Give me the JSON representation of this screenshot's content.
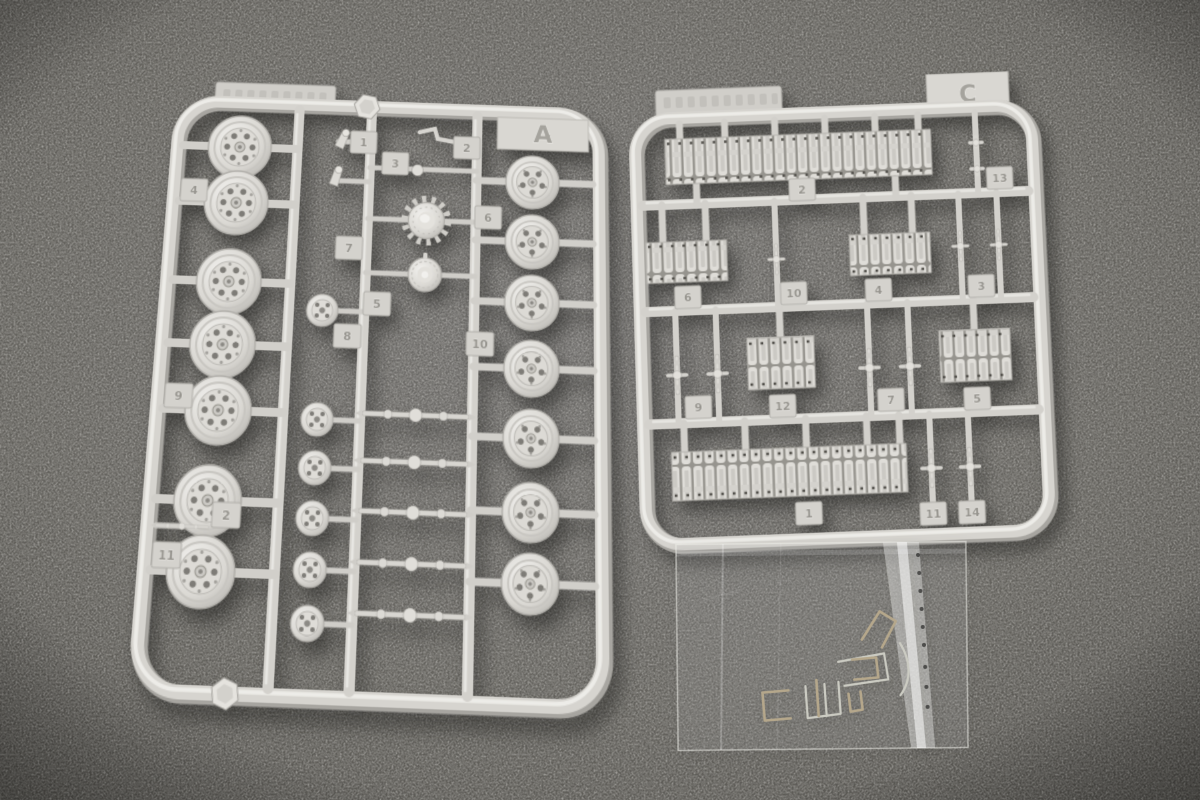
{
  "scene": {
    "description": "Product photograph: two light-gray injection-molded model-kit sprues (runners A and C) holding tank road wheels, a drive sprocket and track-link sections, plus a clear zip bag of bent metal wire parts, lying on dark gray felt",
    "background_color": "#676561",
    "plastic_color": "#d9d7d2",
    "shadow_color": "#2a2926"
  },
  "sprue_a": {
    "letter": "A",
    "part_tabs": [
      "1",
      "3",
      "2",
      "4",
      "7",
      "5",
      "8",
      "9",
      "2",
      "11",
      "6",
      "10"
    ],
    "embossed_maker_text_legible": false
  },
  "sprue_c": {
    "letter": "C",
    "part_tabs": [
      "2",
      "13",
      "6",
      "10",
      "4",
      "3",
      "9",
      "12",
      "7",
      "5",
      "1",
      "11",
      "14"
    ],
    "embossed_maker_text_legible": false
  },
  "bag": {
    "description": "clear plastic bag with bent metal wire handles and a thin metal strip"
  }
}
